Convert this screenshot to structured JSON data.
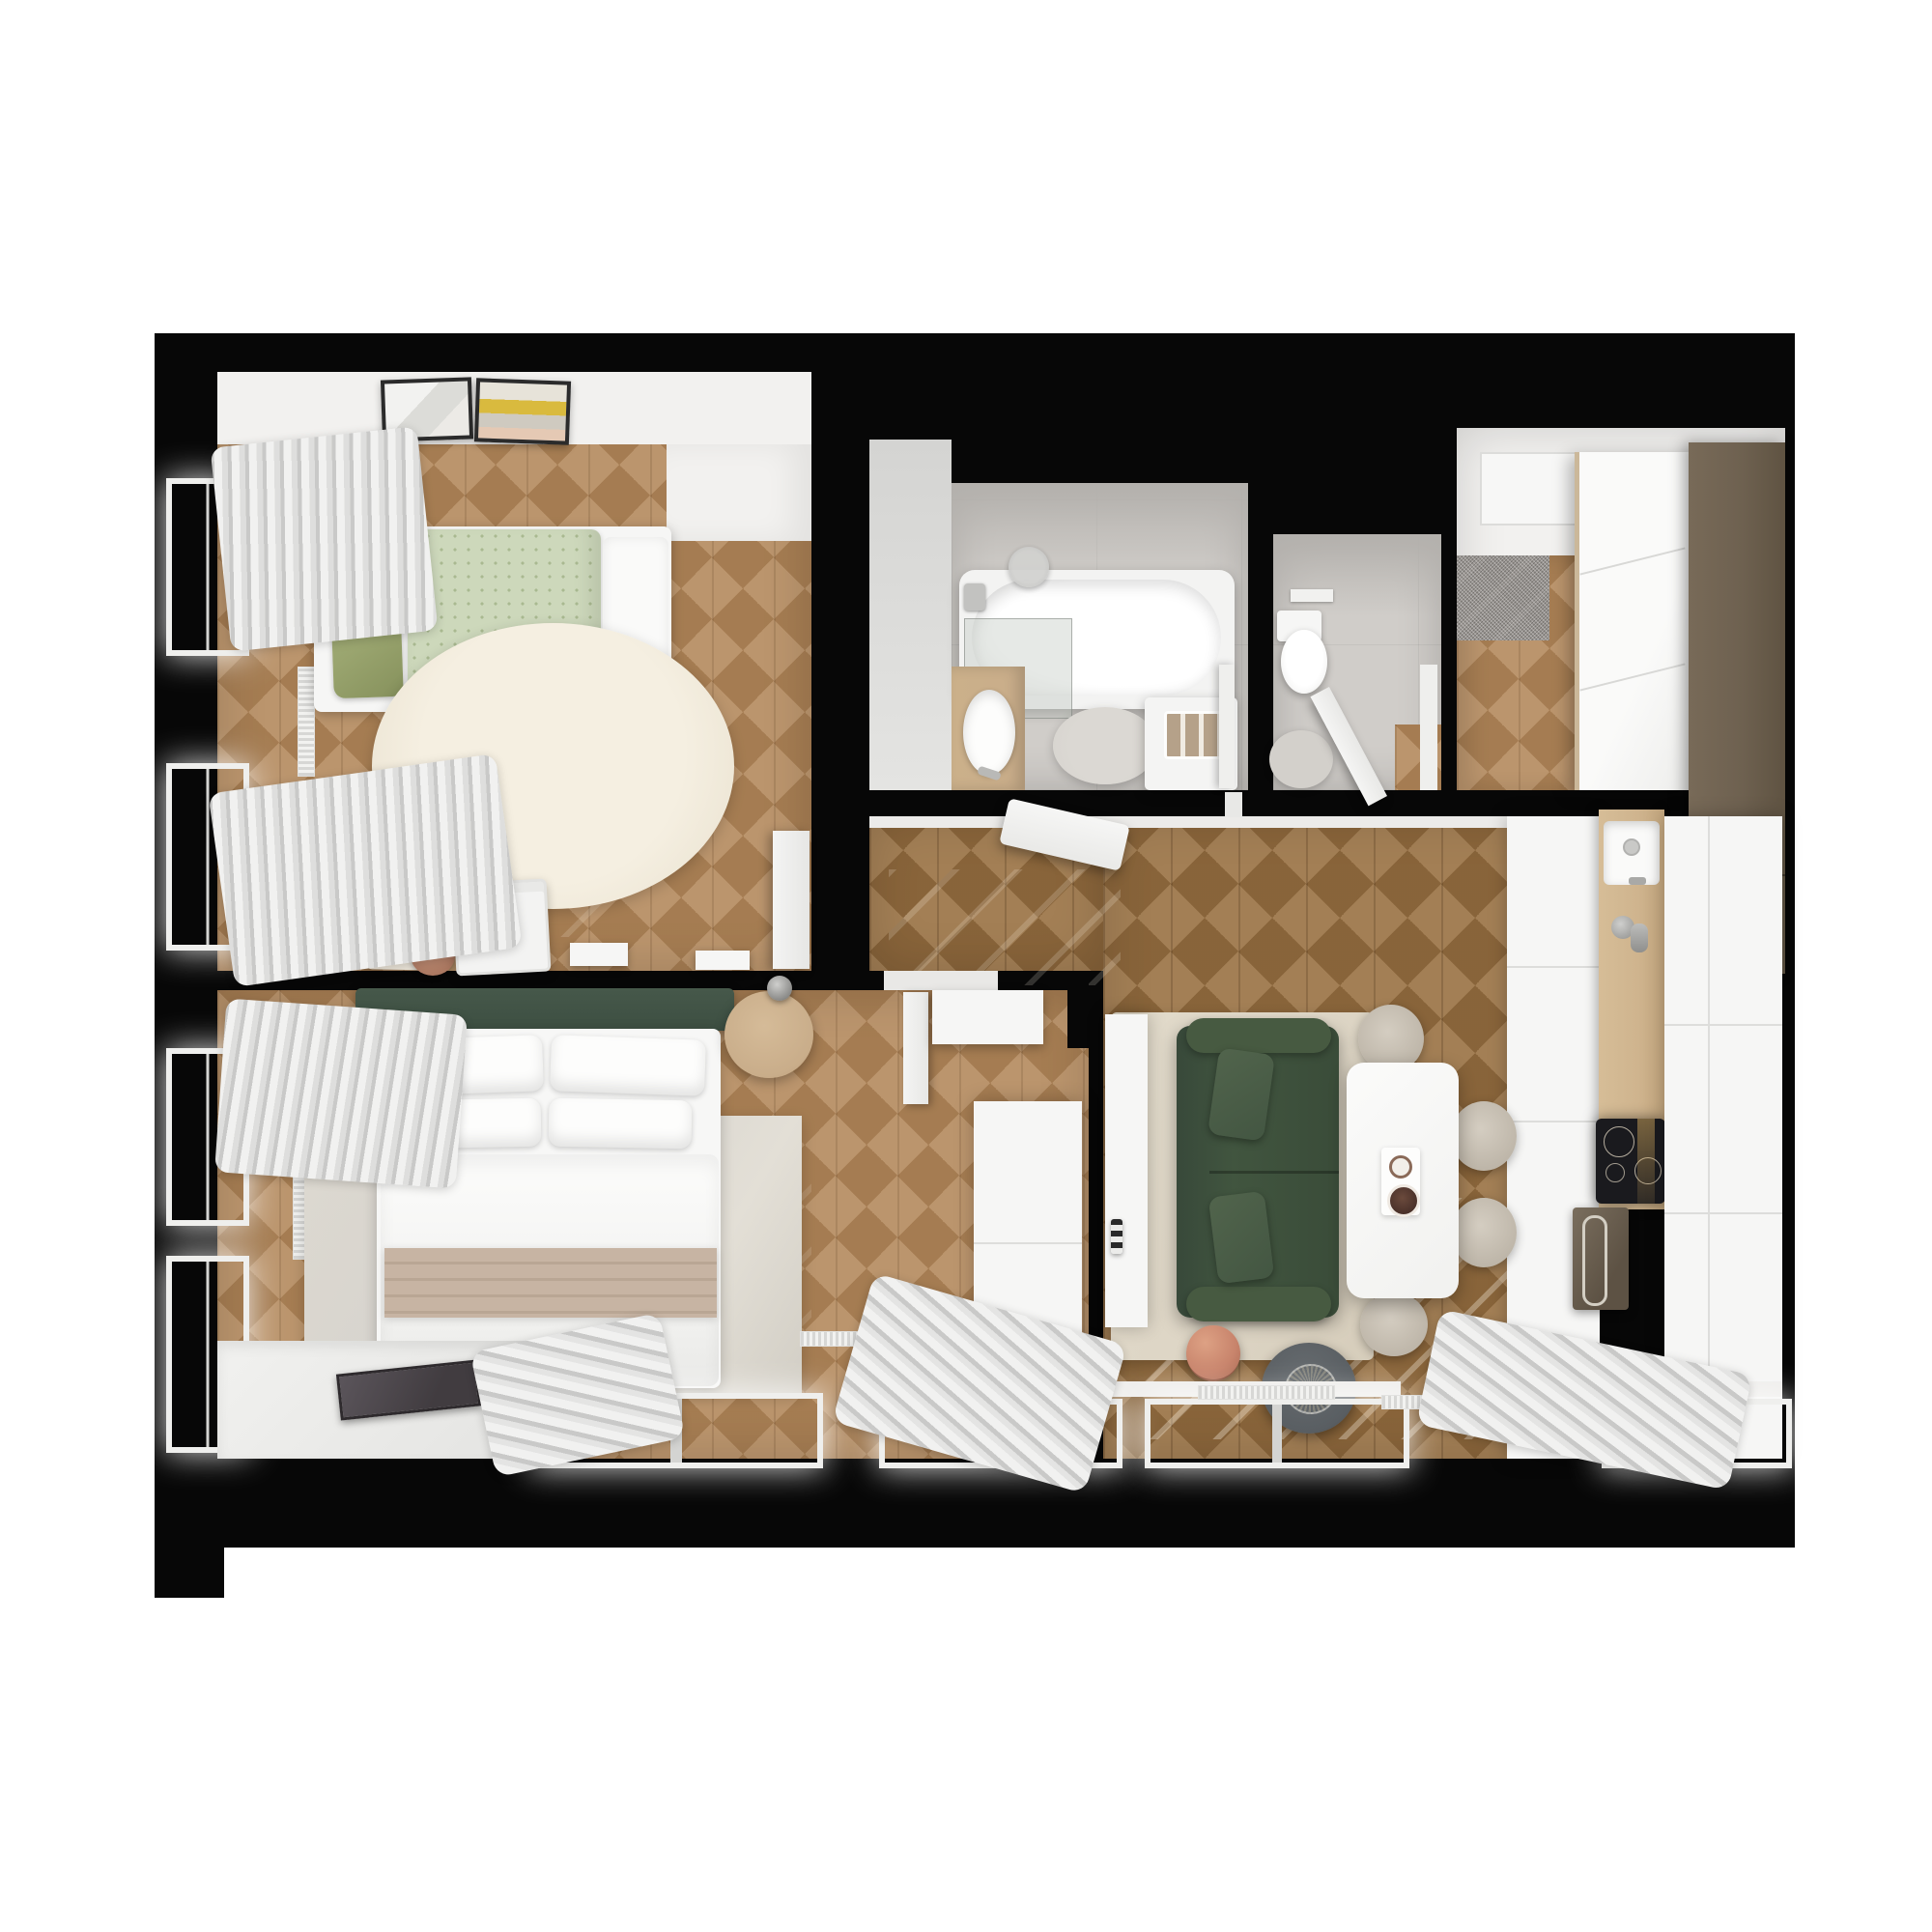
{
  "scene": {
    "type": "3d-floor-plan-top-down-render",
    "text_visible": false
  },
  "palette": {
    "canvas": "#ffffff",
    "outline": "#070707",
    "floor_light": "#b3895c",
    "floor_dark": "#9a7244",
    "wall_face": "#f2f1ef",
    "tile": "#d0cdc9",
    "tile_wall": "#b4b1ad",
    "rug_cream": "#efe8d8",
    "rug_beige": "#ded6c6",
    "rug_grey": "#d6d3ce",
    "sofa_green": "#41553f",
    "headboard_green": "#3d4f42",
    "pillow_green": "#9aa56f",
    "duvet_sage": "#cdd8bb",
    "wood_furniture": "#c9ad8a",
    "counter_wood": "#cfb48e",
    "cabinet_dark": "#6e6150",
    "throw_tan": "#c7b4a3",
    "ball_orange": "#c8846c",
    "pouf_grey": "#595e62",
    "cooktop_black": "#1a1a1e",
    "white": "#f6f6f5",
    "mat_grey": "#9c9894",
    "curtain_light": "#f1f1f0",
    "curtain_dark": "#c9c9c8"
  },
  "rooms": [
    {
      "id": "kids-room",
      "furniture": [
        "single-bed",
        "green-pillow",
        "sage-dotted-duvet",
        "round-cream-rug",
        "kids-desk",
        "rainbow-drawing",
        "round-stool",
        "utility-cart",
        "wall-shelf",
        "wall-shelf-2",
        "two-art-frames",
        "window-curtains",
        "open-door",
        "pendant-lamp"
      ]
    },
    {
      "id": "bathroom",
      "furniture": [
        "bathtub",
        "glass-shower-screen",
        "shower-head",
        "wood-vanity",
        "oval-sink",
        "round-grey-rug",
        "washing-machine",
        "towel-rolls",
        "door-frame"
      ]
    },
    {
      "id": "wc",
      "furniture": [
        "wall-hung-toilet",
        "flush-plate",
        "round-rug",
        "open-door"
      ]
    },
    {
      "id": "entry-hall",
      "furniture": [
        "speckled-doormat",
        "white-sliding-wardrobe",
        "dark-tall-cabinet",
        "recessed-ceiling-light"
      ]
    },
    {
      "id": "hallway",
      "furniture": [
        "open-bathroom-door",
        "bedroom-doorway",
        "sunlight-streaks"
      ]
    },
    {
      "id": "living-room",
      "furniture": [
        "green-two-seat-sofa",
        "sofa-cushions",
        "beige-area-rug",
        "white-dining-table",
        "serving-tray",
        "coffee-cups",
        "dining-chairs-x4",
        "dark-round-pouf-tray",
        "basketball",
        "media-side-cabinet",
        "candle-decor",
        "bottom-windows",
        "curtain-sweeps",
        "radiators"
      ]
    },
    {
      "id": "kitchen",
      "furniture": [
        "white-cabinet-run",
        "wood-countertop",
        "inset-sink",
        "chrome-faucet",
        "induction-cooktop",
        "built-in-oven",
        "tall-white-cabinets",
        "corner-window",
        "curtain"
      ]
    },
    {
      "id": "bedroom",
      "furniture": [
        "double-bed",
        "green-headboard",
        "white-pillows-x4",
        "white-duvet",
        "tan-throw",
        "round-nightstand-left",
        "round-nightstand-right",
        "table-lamps",
        "book",
        "mottled-area-rug",
        "white-desk",
        "open-door",
        "tall-white-wardrobe",
        "window-sill",
        "dark-sill-tray",
        "radiators",
        "windows",
        "curtains"
      ]
    }
  ],
  "counts": {
    "dining_chairs": 4,
    "bed_pillows": 4,
    "towel_rolls": 3,
    "art_frames": 2
  }
}
